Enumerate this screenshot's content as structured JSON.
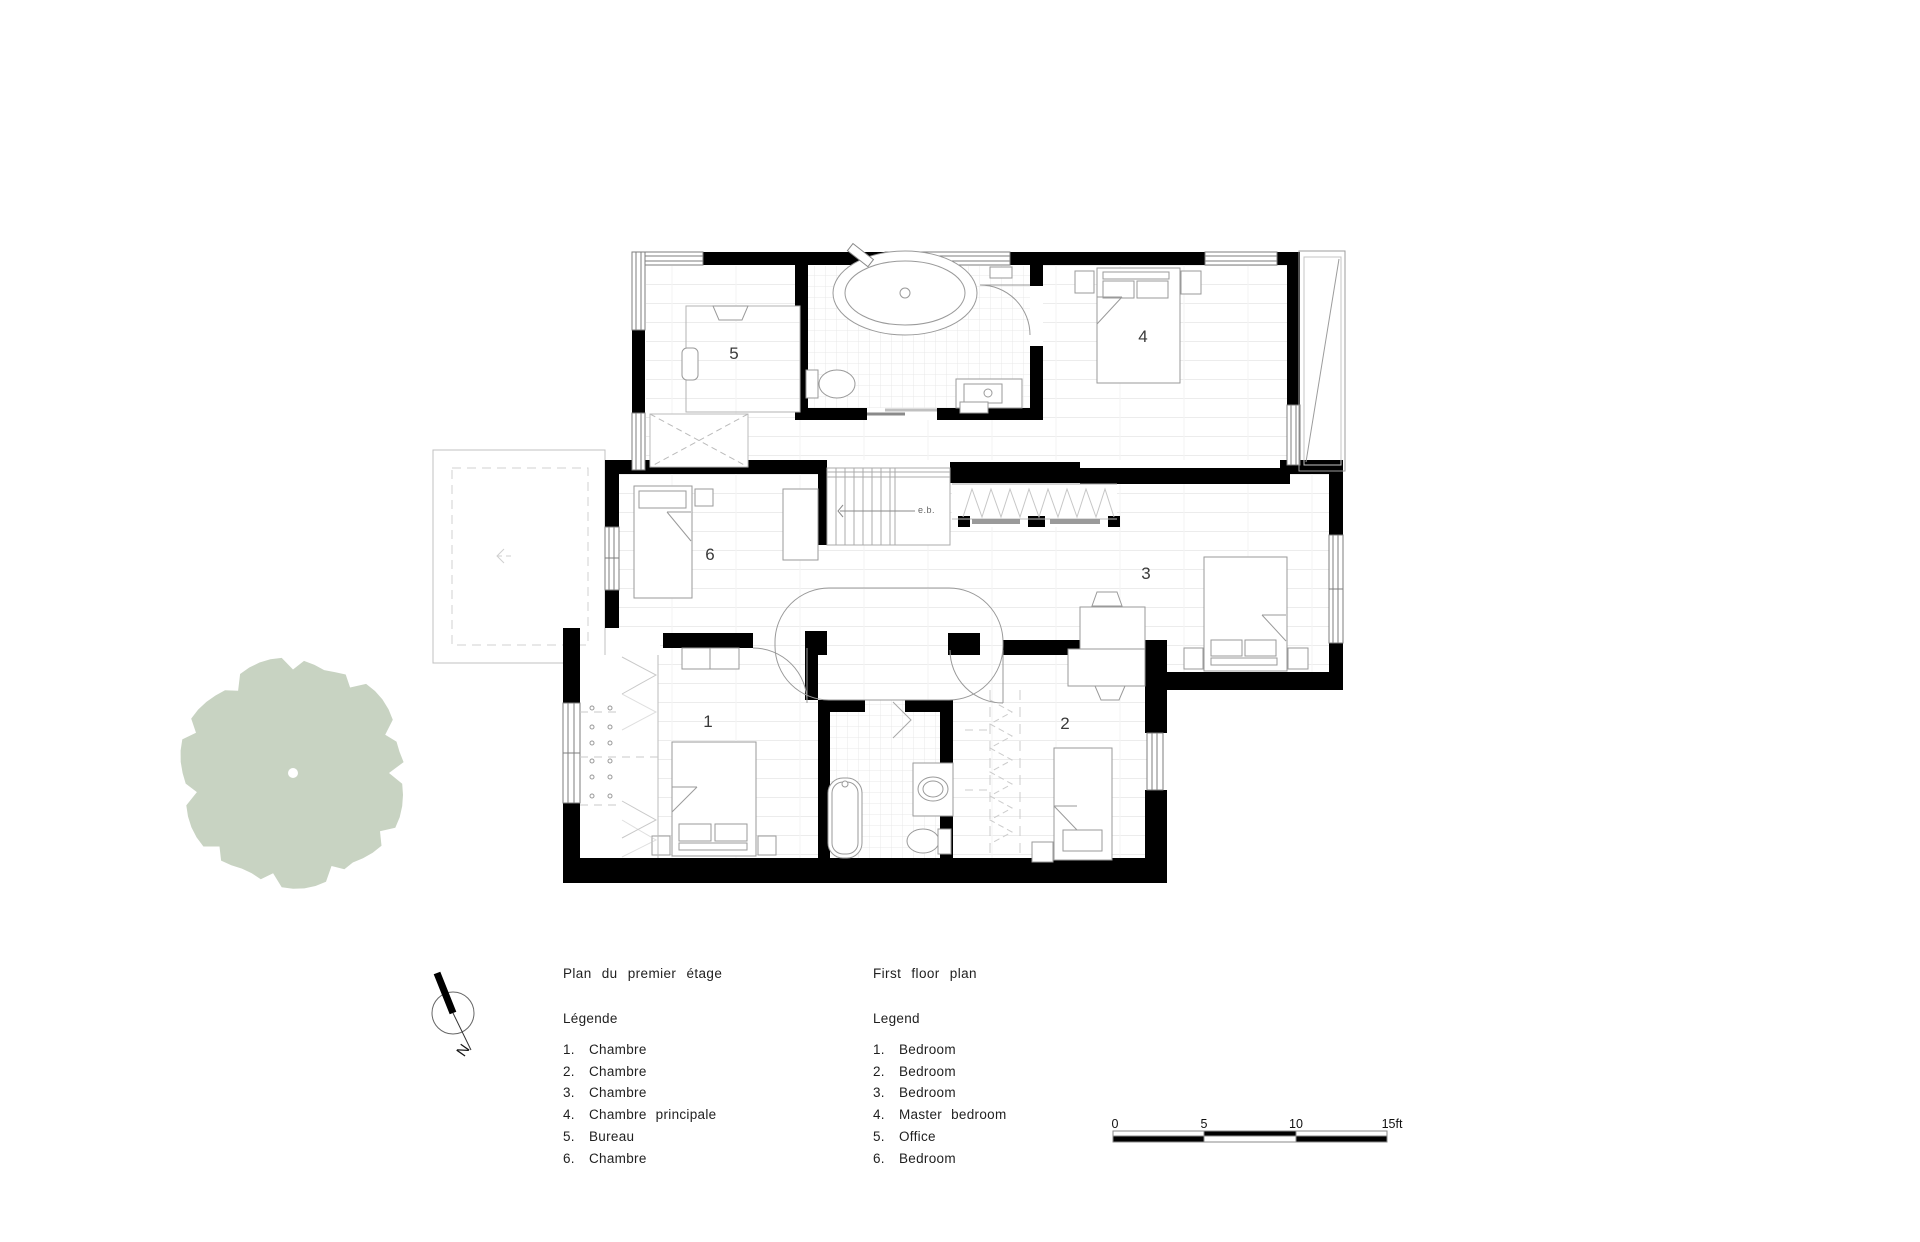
{
  "titles": {
    "fr": "Plan du premier étage",
    "en": "First floor plan"
  },
  "legend_fr": {
    "heading": "Légende",
    "items": [
      {
        "num": "1.",
        "label": "Chambre"
      },
      {
        "num": "2.",
        "label": "Chambre"
      },
      {
        "num": "3.",
        "label": "Chambre"
      },
      {
        "num": "4.",
        "label": "Chambre principale"
      },
      {
        "num": "5.",
        "label": "Bureau"
      },
      {
        "num": "6.",
        "label": "Chambre"
      }
    ]
  },
  "legend_en": {
    "heading": "Legend",
    "items": [
      {
        "num": "1.",
        "label": "Bedroom"
      },
      {
        "num": "2.",
        "label": "Bedroom"
      },
      {
        "num": "3.",
        "label": "Bedroom"
      },
      {
        "num": "4.",
        "label": "Master bedroom"
      },
      {
        "num": "5.",
        "label": "Office"
      },
      {
        "num": "6.",
        "label": "Bedroom"
      }
    ]
  },
  "plan": {
    "room_labels": [
      "1",
      "2",
      "3",
      "4",
      "5",
      "6"
    ],
    "stair_label": "e.b."
  },
  "compass": {
    "label": "N"
  },
  "scale_bar": {
    "ticks": [
      "0",
      "5",
      "10",
      "15ft"
    ]
  },
  "colors": {
    "tree": "#c8d3c2",
    "wall": "#000000",
    "furniture_line": "#9a9a9a"
  }
}
